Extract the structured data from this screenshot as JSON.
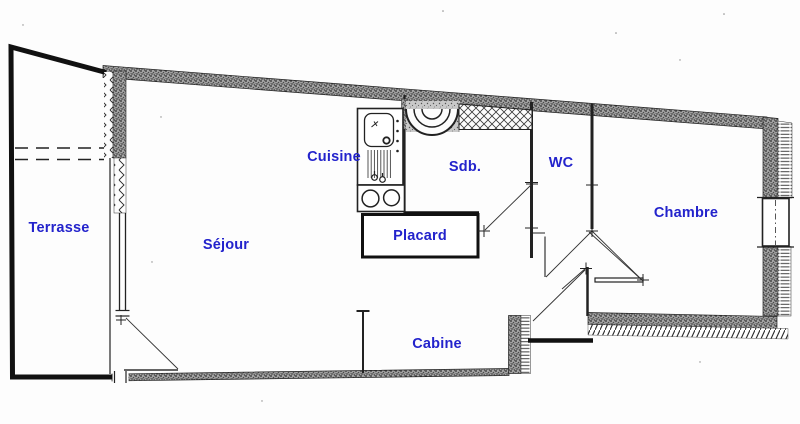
{
  "plan": {
    "labels": {
      "terrasse": "Terrasse",
      "sejour": "Séjour",
      "cuisine": "Cuisine",
      "sdb": "Sdb.",
      "wc": "WC",
      "chambre": "Chambre",
      "placard": "Placard",
      "cabine": "Cabine"
    },
    "colors": {
      "label": "#2323cc",
      "line": "#1c1c1c",
      "wall": "#a6a6a6",
      "background": "#fdfdfd"
    }
  }
}
